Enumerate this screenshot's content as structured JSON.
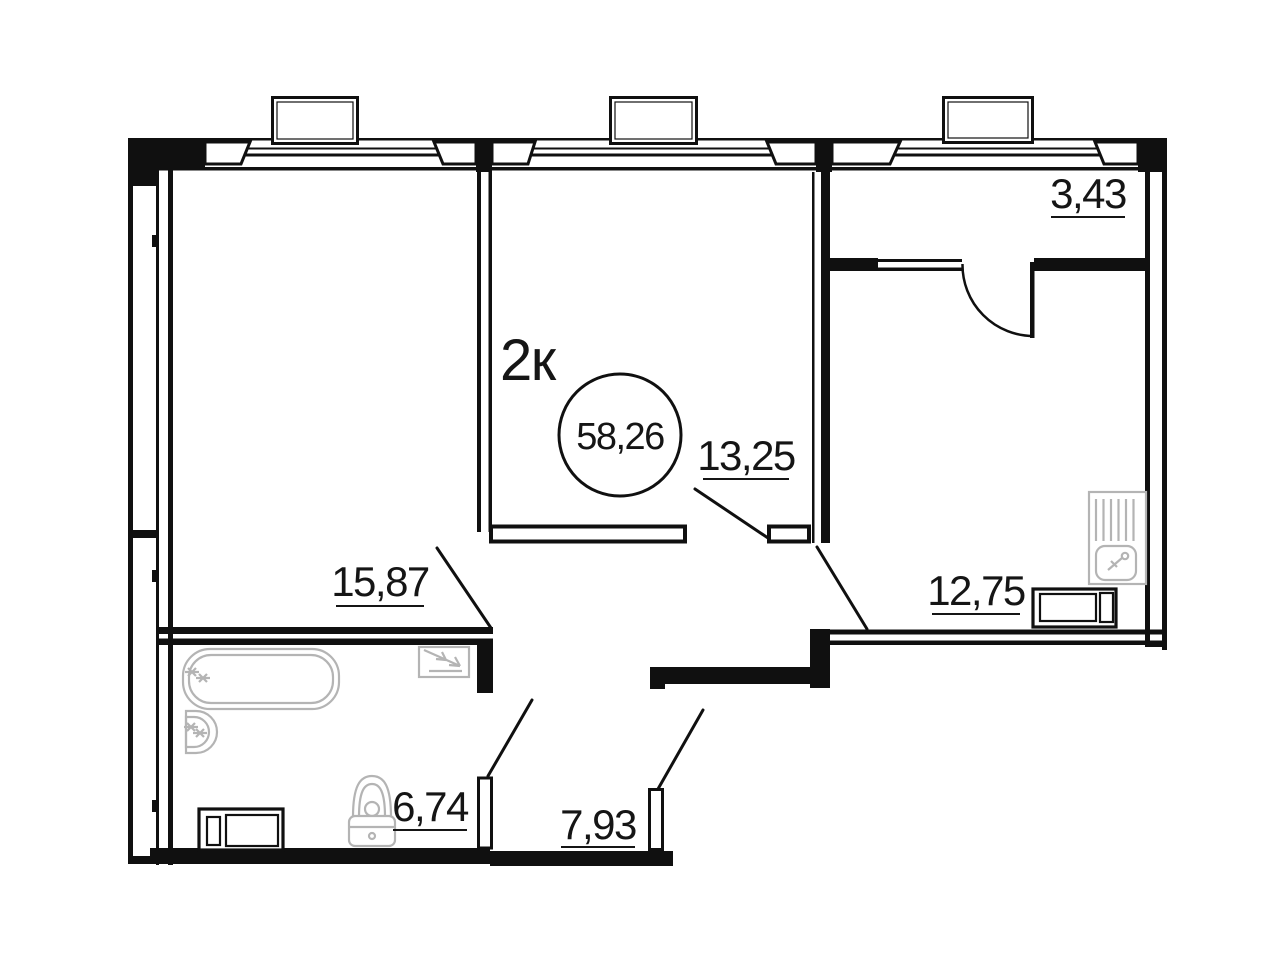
{
  "plan": {
    "title": "2к",
    "total_area": "58,26",
    "rooms": [
      {
        "id": "living-room-1",
        "area": "15,87"
      },
      {
        "id": "living-room-2",
        "area": "13,25"
      },
      {
        "id": "kitchen",
        "area": "12,75"
      },
      {
        "id": "bathroom",
        "area": "6,74"
      },
      {
        "id": "corridor",
        "area": "7,93"
      },
      {
        "id": "entry-hall",
        "area": "3,43"
      }
    ],
    "icons": [
      "bathtub-icon",
      "wash-basin-icon",
      "toilet-icon",
      "washing-machine-icon",
      "shower-vent-icon",
      "kitchen-sink-icon",
      "stove-icon",
      "window-icon",
      "door-swing-icon"
    ],
    "colors": {
      "walls": "#101010",
      "fixtures": "#b4b4b4",
      "background": "#ffffff",
      "text": "#151515"
    }
  }
}
